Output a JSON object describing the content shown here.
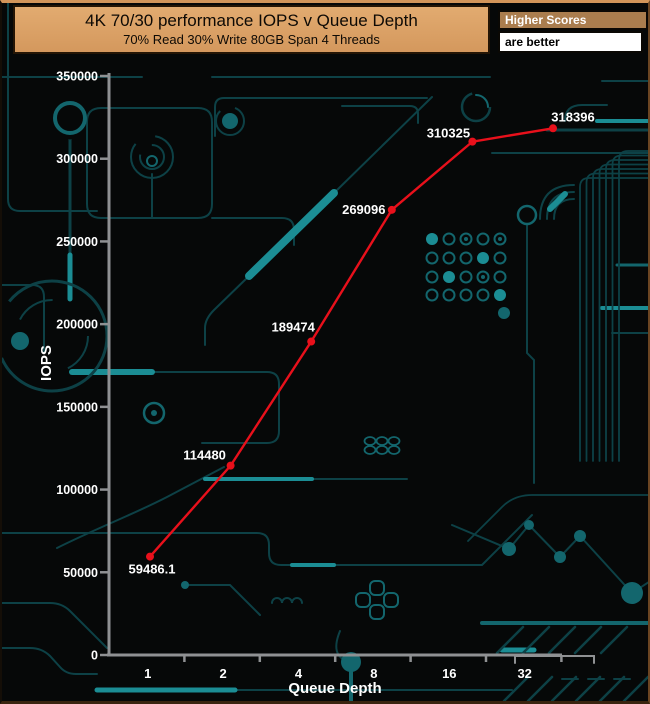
{
  "header": {
    "title": "4K 70/30 performance IOPS v Queue Depth",
    "subtitle": "70% Read 30% Write 80GB Span 4 Threads",
    "badge_title": "Higher Scores",
    "badge_subtitle": "are better"
  },
  "chart_data": {
    "type": "line",
    "title": "4K 70/30 performance IOPS v Queue Depth",
    "subtitle": "70% Read 30% Write 80GB Span 4 Threads",
    "xlabel": "Queue Depth",
    "ylabel": "IOPS",
    "x_scale": "log2-categorical",
    "categories": [
      "1",
      "2",
      "4",
      "8",
      "16",
      "32"
    ],
    "series": [
      {
        "name": "4K 70/30 IOPS",
        "color": "#e8101b",
        "values": [
          59486.1,
          114480,
          189474,
          269096,
          310325,
          318396
        ]
      }
    ],
    "point_labels": [
      "59486.1",
      "114480",
      "189474",
      "269096",
      "310325",
      "318396"
    ],
    "ylim": [
      0,
      350000
    ],
    "y_tick_labels": [
      "0",
      "50000",
      "100000",
      "150000",
      "200000",
      "250000",
      "300000",
      "350000"
    ],
    "grid": false,
    "legend_position": "none",
    "annotations": [
      "Higher Scores",
      "are better"
    ]
  },
  "colors": {
    "line": "#e8101b",
    "axis": "#8f9193",
    "label_text": "#ffffff",
    "header_bg": "#dba269",
    "badge_bg": "#aa7d4e",
    "background": "#060808",
    "circuit_dark": "#0d4146",
    "circuit_mid": "#13666d",
    "circuit_bright": "#1b8d94"
  }
}
